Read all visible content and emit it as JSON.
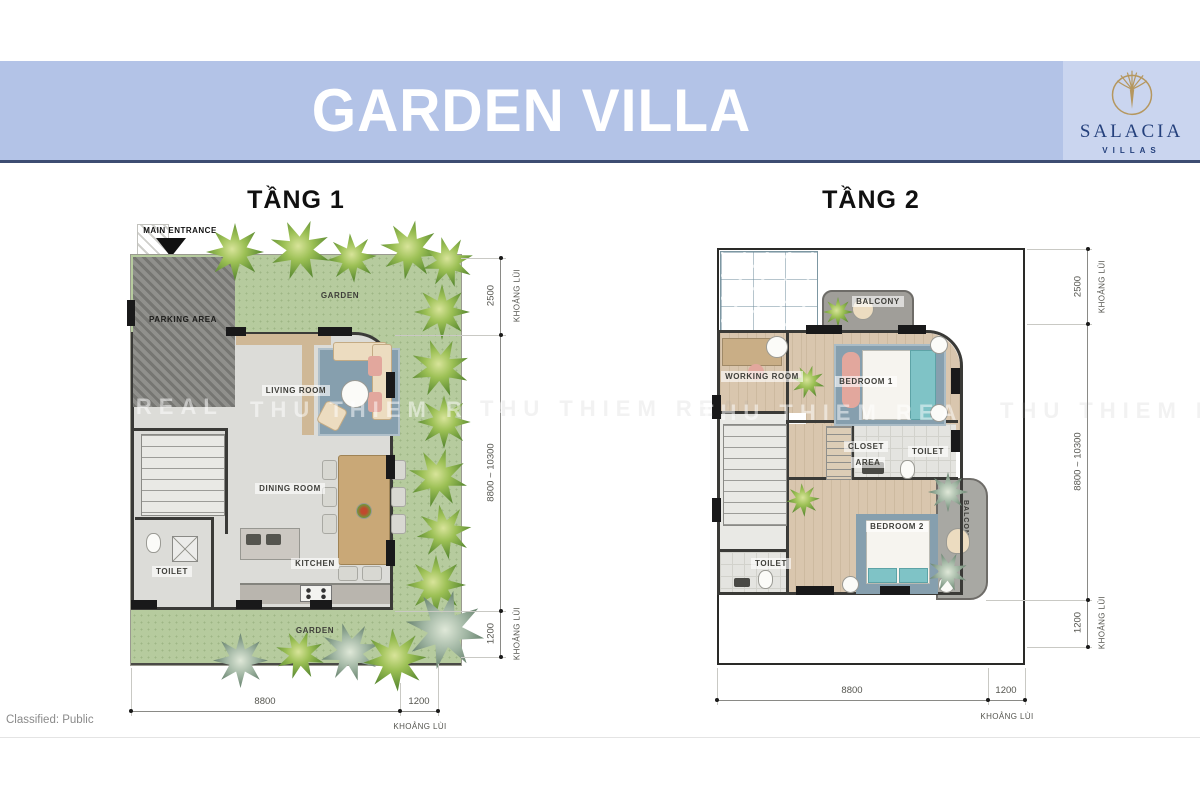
{
  "header": {
    "title": "GARDEN VILLA",
    "brand": {
      "name": "SALACIA",
      "sub": "VILLAS",
      "logo_icon": "palm-tree-circle-icon"
    }
  },
  "colors": {
    "banner": "#b3c3e7",
    "logo_panel": "#cad5ef",
    "banner_underline": "#3d4d72",
    "brand_navy": "#24407c",
    "brand_gold": "#b5975f",
    "garden_green": "#b6cb9e",
    "wall_dark": "#3a3a37"
  },
  "floor1": {
    "title": "TẦNG 1",
    "entrance_label": "MAIN ENTRANCE",
    "labels": {
      "garden_top": "GARDEN",
      "parking": "PARKING AREA",
      "living": "LIVING ROOM",
      "dining": "DINING ROOM",
      "toilet": "TOILET",
      "kitchen": "KITCHEN",
      "garden_bottom": "GARDEN"
    },
    "dimensions": {
      "right": [
        {
          "value": "2500",
          "note": "KHOẢNG LÙI"
        },
        {
          "value": "8800 ~ 10300",
          "note": ""
        },
        {
          "value": "1200",
          "note": "KHOẢNG LÙI"
        }
      ],
      "bottom": [
        {
          "value": "8800",
          "note": ""
        },
        {
          "value": "1200",
          "note": "KHOẢNG LÙI"
        }
      ]
    }
  },
  "floor2": {
    "title": "TẦNG 2",
    "labels": {
      "balcony_top": "BALCONY",
      "working": "WORKING ROOM",
      "bedroom1": "BEDROOM 1",
      "closet_line1": "CLOSET",
      "closet_line2": "AREA",
      "toilet1": "TOILET",
      "bedroom2": "BEDROOM 2",
      "balcony_right": "BALCONY",
      "toilet2": "TOILET"
    },
    "dimensions": {
      "right": [
        {
          "value": "2500",
          "note": "KHOẢNG LÙI"
        },
        {
          "value": "8800 ~ 10300",
          "note": ""
        },
        {
          "value": "1200",
          "note": "KHOẢNG LÙI"
        }
      ],
      "bottom": [
        {
          "value": "8800",
          "note": ""
        },
        {
          "value": "1200",
          "note": "KHOẢNG LÙI"
        }
      ]
    }
  },
  "watermark": {
    "text": "THU THIEM REAL"
  },
  "footer": {
    "classification": "Classified: Public"
  }
}
